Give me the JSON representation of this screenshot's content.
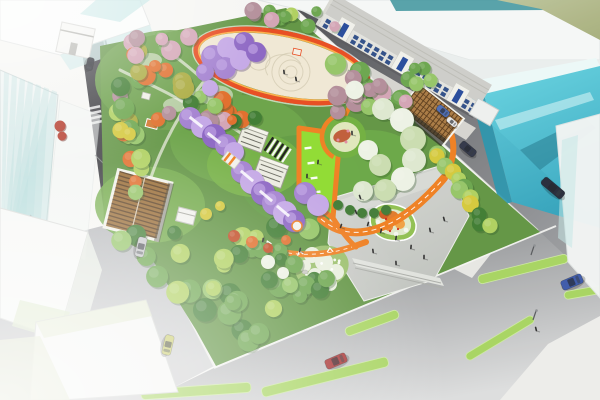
{
  "scene": {
    "description": "Aerial 3D architectural rendering of an urban pocket-park master plan: oval event plaza, wisteria tunnels, orange jogging loop, lime event lawn, spiral flower garden and entry plaza, surrounded by streets, sketch massing buildings and a glass tower",
    "style": "daytime aerial render, sketch-white context buildings",
    "elements": [
      "oval-event-plaza",
      "wisteria-tunnel",
      "orange-loop-path",
      "lime-event-lawn",
      "spiral-flower-garden",
      "entry-plaza",
      "west-pergola-pavilion",
      "east-pergola-pavilion",
      "street-row-building",
      "glass-tower",
      "main-avenue",
      "pocket-forest"
    ]
  },
  "palette": {
    "bg": "#f6f6f3",
    "road_dark": "#3a3a3f",
    "sidewalk": "#e9e9e5",
    "park_base": "#5f9340",
    "lawn_bright": "#8edb2e",
    "path_orange": "#ef7d1e",
    "path_red": "#e8491d",
    "plaza_cream": "#f0e8d4",
    "plaza_gray": "#cbcec9",
    "pergola_brown": "#96682f",
    "pergola_dark": "#573a1c",
    "lattice_brown": "#a87840",
    "wisteria": "#a27fd0",
    "wisteria_light": "#c3a6e6",
    "wisteria_dark": "#8a63c2",
    "glass_teal": "#4cc3d6",
    "glass_teal_dark": "#2493ac",
    "glass_pale": "#cfeae8",
    "window_blue": "#1d3f7e",
    "building_white": "#f5f6f4",
    "olive_ground": "#b2ba8c",
    "median_green": "#a6d45e",
    "curb_white": "#f6f6f3",
    "tree_green_dark": "#3c7a2e",
    "tree_green": "#69a44a",
    "tree_green_light": "#93c464",
    "tree_lime": "#aed05c",
    "tree_olive": "#a9a93b",
    "tree_yellow": "#d4c838",
    "tree_orange": "#e06c28",
    "tree_red": "#c0481f",
    "tree_mauve": "#b18b97",
    "tree_pink": "#d3a3b4",
    "tree_pale": "#dde8cf",
    "tree_white": "#edf2e4",
    "people_dark": "#2c2c2c"
  },
  "cars": [
    {
      "name": "car-silver-left-road",
      "x": 141,
      "y": 247,
      "angle": 103,
      "color": "#c8c9cb",
      "len": 20,
      "w": 9
    },
    {
      "name": "car-yellow-side-street",
      "x": 168,
      "y": 345,
      "angle": 103,
      "color": "#c9cc6a",
      "len": 20,
      "w": 9
    },
    {
      "name": "car-red-avenue",
      "x": 336,
      "y": 361,
      "angle": -23,
      "color": "#a83232",
      "len": 22,
      "w": 10
    },
    {
      "name": "car-blue-avenue",
      "x": 572,
      "y": 282,
      "angle": -23,
      "color": "#3a57a8",
      "len": 22,
      "w": 10
    },
    {
      "name": "car-dark-top-road",
      "x": 90,
      "y": 64,
      "angle": 103,
      "color": "#24262e",
      "len": 13,
      "w": 7
    },
    {
      "name": "car-blue-top-street",
      "x": 443,
      "y": 111,
      "angle": 40,
      "color": "#4a6ab2",
      "len": 14,
      "w": 7
    },
    {
      "name": "car-white-top-street",
      "x": 452,
      "y": 122,
      "angle": 40,
      "color": "#e8e8e8",
      "len": 12,
      "w": 6
    },
    {
      "name": "van-dark-right-street",
      "x": 468,
      "y": 149,
      "angle": 40,
      "color": "#2e3445",
      "len": 18,
      "w": 8
    },
    {
      "name": "bus-dark-right-street",
      "x": 553,
      "y": 188,
      "angle": 40,
      "color": "#232837",
      "len": 26,
      "w": 9
    }
  ]
}
